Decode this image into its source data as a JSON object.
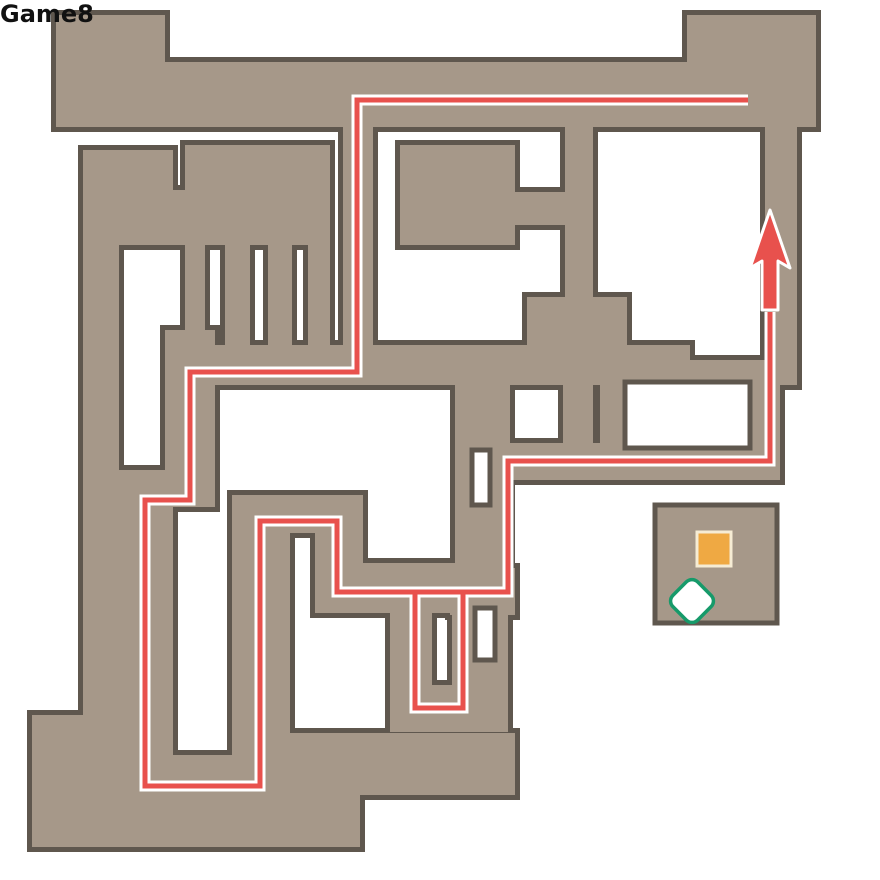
{
  "title": "dungeon floor map",
  "map": {
    "width": 880,
    "height": 880,
    "floor": "#a69889",
    "wall": "#5f574e",
    "background": "#ffffff",
    "rooms": [
      [
        56,
        15,
        109,
        112
      ],
      [
        56,
        62,
        760,
        65
      ],
      [
        687,
        15,
        129,
        112
      ],
      [
        765,
        127,
        32,
        258
      ],
      [
        565,
        127,
        28,
        180
      ],
      [
        400,
        145,
        115,
        100
      ],
      [
        513,
        192,
        55,
        33
      ],
      [
        343,
        127,
        30,
        258
      ],
      [
        83,
        150,
        90,
        95
      ],
      [
        83,
        150,
        36,
        570
      ],
      [
        185,
        145,
        145,
        100
      ],
      [
        160,
        190,
        60,
        55
      ],
      [
        185,
        240,
        20,
        105
      ],
      [
        225,
        240,
        25,
        108
      ],
      [
        268,
        240,
        24,
        108
      ],
      [
        308,
        240,
        22,
        108
      ],
      [
        165,
        345,
        525,
        40
      ],
      [
        165,
        330,
        50,
        177
      ],
      [
        119,
        470,
        54,
        320
      ],
      [
        117,
        755,
        180,
        48
      ],
      [
        232,
        495,
        58,
        308
      ],
      [
        232,
        495,
        131,
        38
      ],
      [
        315,
        495,
        48,
        115
      ],
      [
        315,
        563,
        155,
        50
      ],
      [
        390,
        563,
        42,
        150
      ],
      [
        390,
        685,
        112,
        47
      ],
      [
        452,
        580,
        56,
        152
      ],
      [
        450,
        568,
        65,
        47
      ],
      [
        455,
        383,
        55,
        232
      ],
      [
        455,
        443,
        325,
        37
      ],
      [
        527,
        297,
        100,
        86
      ],
      [
        563,
        383,
        30,
        77
      ],
      [
        600,
        360,
        180,
        117
      ],
      [
        32,
        715,
        98,
        132
      ],
      [
        130,
        793,
        230,
        54
      ],
      [
        290,
        733,
        225,
        62
      ]
    ],
    "holes": [
      [
        625,
        382,
        125,
        66
      ],
      [
        472,
        450,
        18,
        55
      ],
      [
        475,
        608,
        20,
        52
      ]
    ]
  },
  "route": {
    "color": "#e8514d",
    "casing": "#ffffff",
    "points": [
      [
        748,
        100
      ],
      [
        357,
        100
      ],
      [
        357,
        372
      ],
      [
        190,
        372
      ],
      [
        190,
        500
      ],
      [
        145,
        500
      ],
      [
        145,
        786
      ],
      [
        260,
        786
      ],
      [
        260,
        521
      ],
      [
        337,
        521
      ],
      [
        337,
        592
      ],
      [
        463,
        592
      ],
      [
        463,
        708
      ],
      [
        415,
        708
      ],
      [
        415,
        592
      ],
      [
        508,
        592
      ],
      [
        508,
        461
      ],
      [
        770,
        461
      ],
      [
        770,
        312
      ]
    ],
    "arrow": [
      [
        770,
        210
      ],
      [
        790,
        268
      ],
      [
        778,
        261
      ],
      [
        778,
        310
      ],
      [
        762,
        310
      ],
      [
        762,
        261
      ],
      [
        750,
        268
      ]
    ]
  },
  "labels": {
    "start": "START",
    "goal": "GOAL",
    "bg": "#f4524c",
    "start_pos": [
      786,
      62
    ],
    "goal_pos": [
      785,
      184
    ]
  },
  "markers": {
    "fill": "#f8ed1a",
    "ring": "#111111",
    "outer_ring": "#ffffff",
    "items": [
      {
        "n": "1",
        "x": 80,
        "y": 55
      },
      {
        "n": "2",
        "x": 272,
        "y": 255
      },
      {
        "n": "3",
        "x": 151,
        "y": 161
      },
      {
        "n": "4",
        "x": 101,
        "y": 691
      },
      {
        "n": "5",
        "x": 579,
        "y": 370
      },
      {
        "n": "6",
        "x": 502,
        "y": 789
      }
    ]
  },
  "badges": {
    "green": "#169a6a",
    "orange": "#dd7d15",
    "fill": "#ffffff",
    "items": [
      {
        "t": "ア",
        "c": "green",
        "x": 75,
        "y": 100
      },
      {
        "t": "ア",
        "c": "green",
        "x": 178,
        "y": 211
      },
      {
        "t": "ア",
        "c": "green",
        "x": 208,
        "y": 342
      },
      {
        "t": "ア",
        "c": "green",
        "x": 578,
        "y": 128
      },
      {
        "t": "ア",
        "c": "green",
        "x": 518,
        "y": 372
      },
      {
        "t": "ア",
        "c": "green",
        "x": 575,
        "y": 413
      },
      {
        "t": "ア",
        "c": "green",
        "x": 465,
        "y": 552
      },
      {
        "t": "イ",
        "c": "green",
        "x": 372,
        "y": 567
      },
      {
        "t": "ア",
        "c": "green",
        "x": 335,
        "y": 622
      },
      {
        "t": "ア",
        "c": "green",
        "x": 440,
        "y": 600
      },
      {
        "t": "ア",
        "c": "green",
        "x": 500,
        "y": 620
      },
      {
        "t": "ア",
        "c": "green",
        "x": 187,
        "y": 757
      },
      {
        "t": "ウ",
        "c": "orange",
        "x": 755,
        "y": 107
      }
    ]
  },
  "legend": {
    "boxes": [
      {
        "x": 655,
        "y": 505,
        "w": 122,
        "h": 118,
        "chest": {
          "x": 714,
          "y": 549,
          "size": 34,
          "fill": "#efa943",
          "border": "#f6ecd4"
        },
        "badges": [
          {
            "t": "ウ",
            "c": "green",
            "x": 692,
            "y": 601
          },
          {
            "t": "イ",
            "c": "orange",
            "x": 751,
            "y": 601
          }
        ]
      },
      {
        "x": 653,
        "y": 695,
        "w": 125,
        "h": 120,
        "chest": null,
        "badges": [
          {
            "t": "ウ",
            "c": "green",
            "x": 690,
            "y": 772
          },
          {
            "t": "ア",
            "c": "orange",
            "x": 747,
            "y": 772
          }
        ]
      }
    ]
  },
  "logo": {
    "text": "Game8",
    "text_pos": [
      784,
      792
    ],
    "bee_color": "#e8c852"
  }
}
